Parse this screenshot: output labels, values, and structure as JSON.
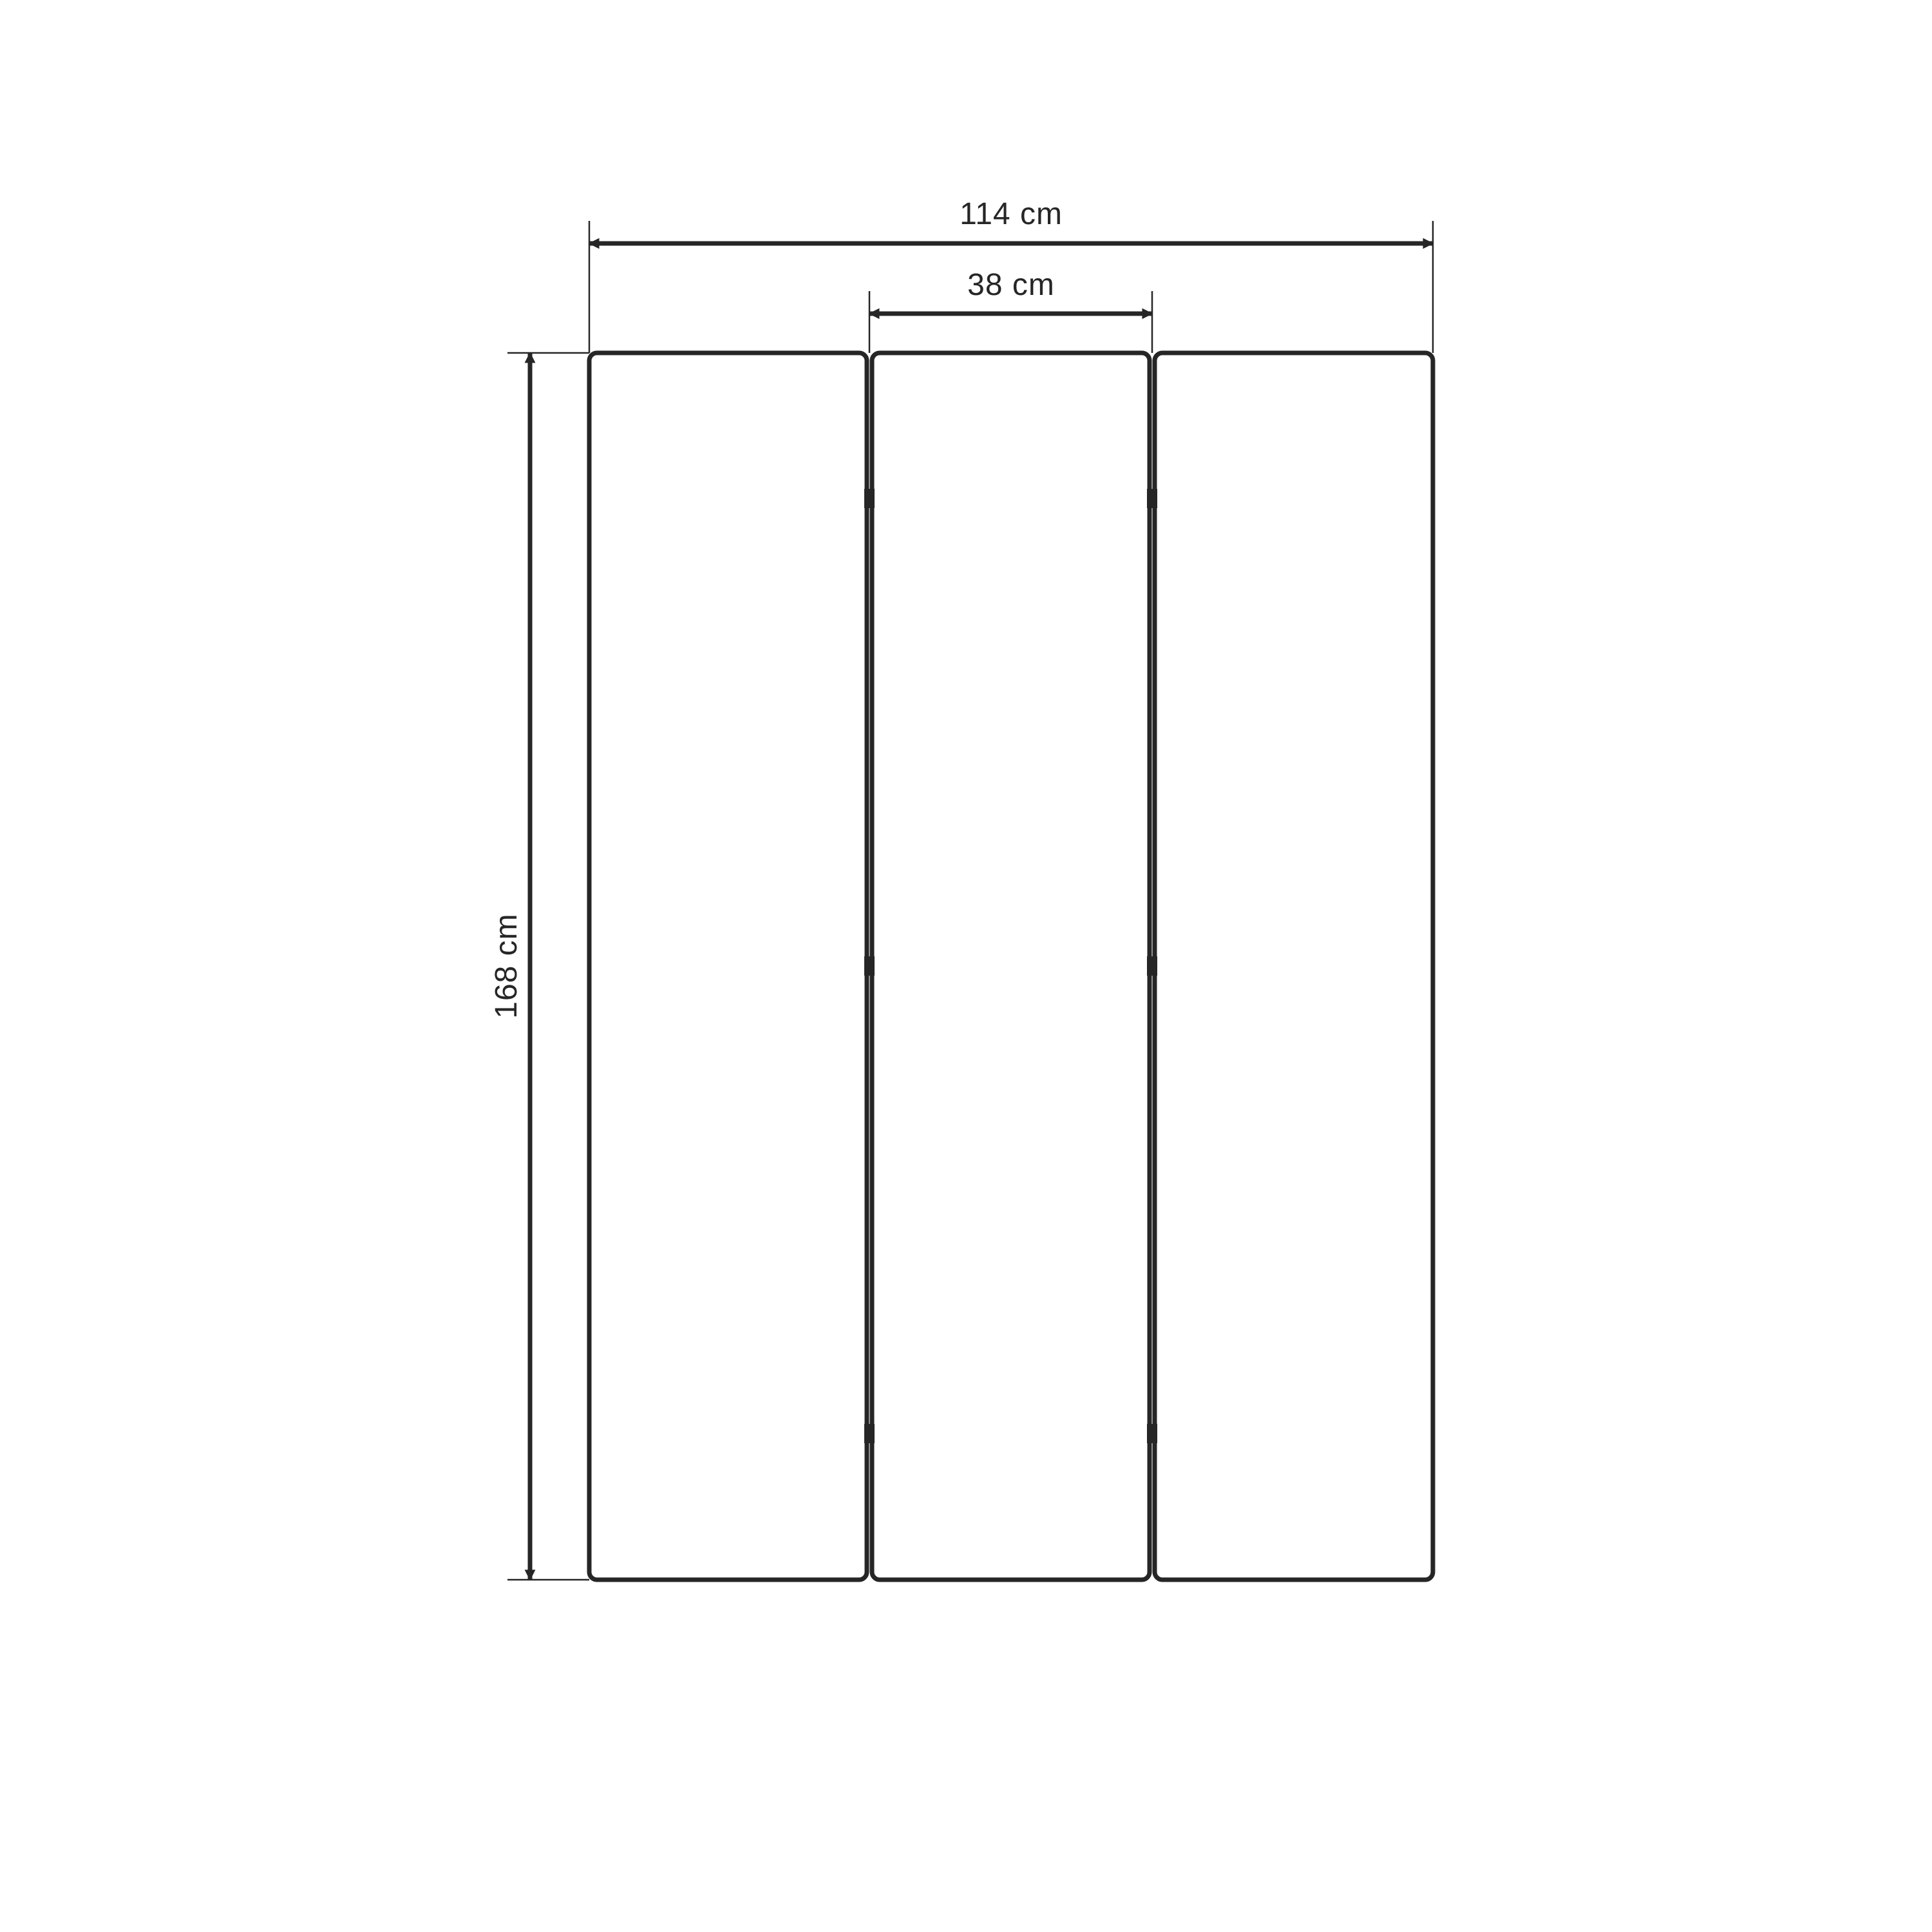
{
  "diagram": {
    "type": "technical-dimension-drawing",
    "subject": "three-panel folding screen, front view",
    "panel_count": 3,
    "hinge_rows": 3,
    "colors": {
      "line": "#262626",
      "background": "#ffffff",
      "panel_fill": "#ffffff"
    },
    "dimensions": {
      "total_width": {
        "value": 114,
        "unit": "cm",
        "label": "114 cm"
      },
      "panel_width": {
        "value": 38,
        "unit": "cm",
        "label": "38 cm"
      },
      "height": {
        "value": 168,
        "unit": "cm",
        "label": "168 cm"
      }
    }
  }
}
